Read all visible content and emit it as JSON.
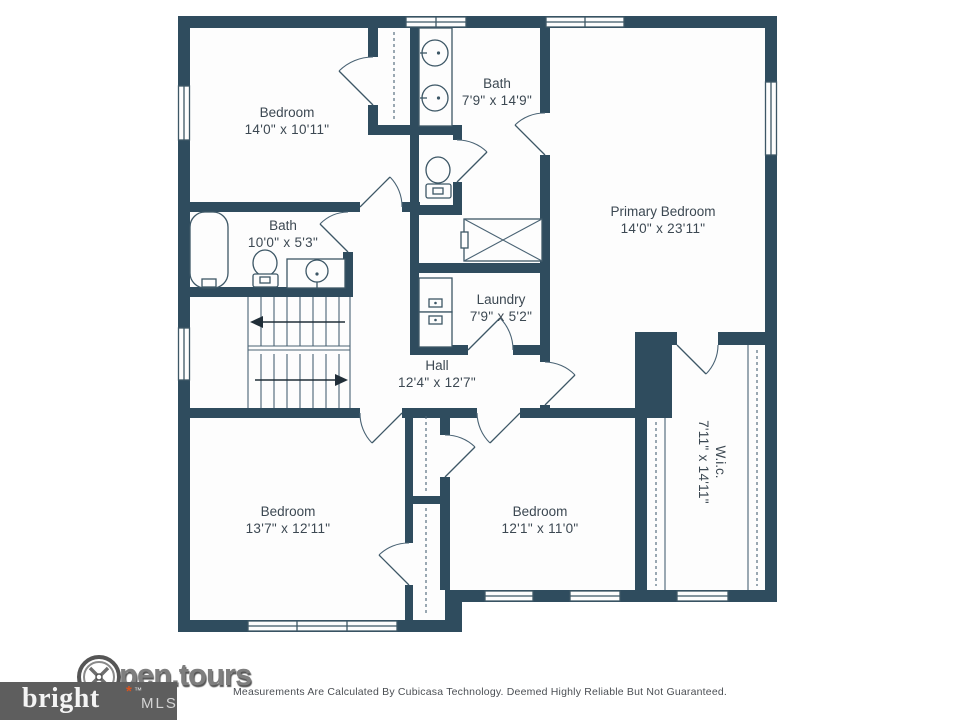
{
  "colors": {
    "wall": "#2f4c5e",
    "fixture_line": "#3d5766",
    "label_text": "#3c4852",
    "floor": "#fdfdfd",
    "disclaimer_text": "#4b4f54",
    "opentours_gray": "#7e7e7e",
    "bright_box": "#5e5e5e",
    "bright_accent": "#d9531e"
  },
  "rooms": [
    {
      "name": "Bedroom",
      "dims": "14'0\" x 10'11\""
    },
    {
      "name": "Bath",
      "dims": "7'9\" x 14'9\""
    },
    {
      "name": "Primary Bedroom",
      "dims": "14'0\" x 23'11\""
    },
    {
      "name": "Bath",
      "dims": "10'0\" x 5'3\""
    },
    {
      "name": "Laundry",
      "dims": "7'9\" x 5'2\""
    },
    {
      "name": "Hall",
      "dims": "12'4\" x 12'7\""
    },
    {
      "name": "Bedroom",
      "dims": "13'7\" x 12'11\""
    },
    {
      "name": "Bedroom",
      "dims": "12'1\" x 11'0\""
    },
    {
      "name": "W.i.c.",
      "dims": "7'11\" x 14'11\""
    }
  ],
  "footer": {
    "disclaimer": "Measurements Are Calculated By Cubicasa Technology. Deemed Highly Reliable But Not Guaranteed."
  },
  "logos": {
    "opentours_text": "pen.tours",
    "bright_text": "bright",
    "bright_spark": "*",
    "bright_tm": "™",
    "mls_text": "MLS"
  }
}
